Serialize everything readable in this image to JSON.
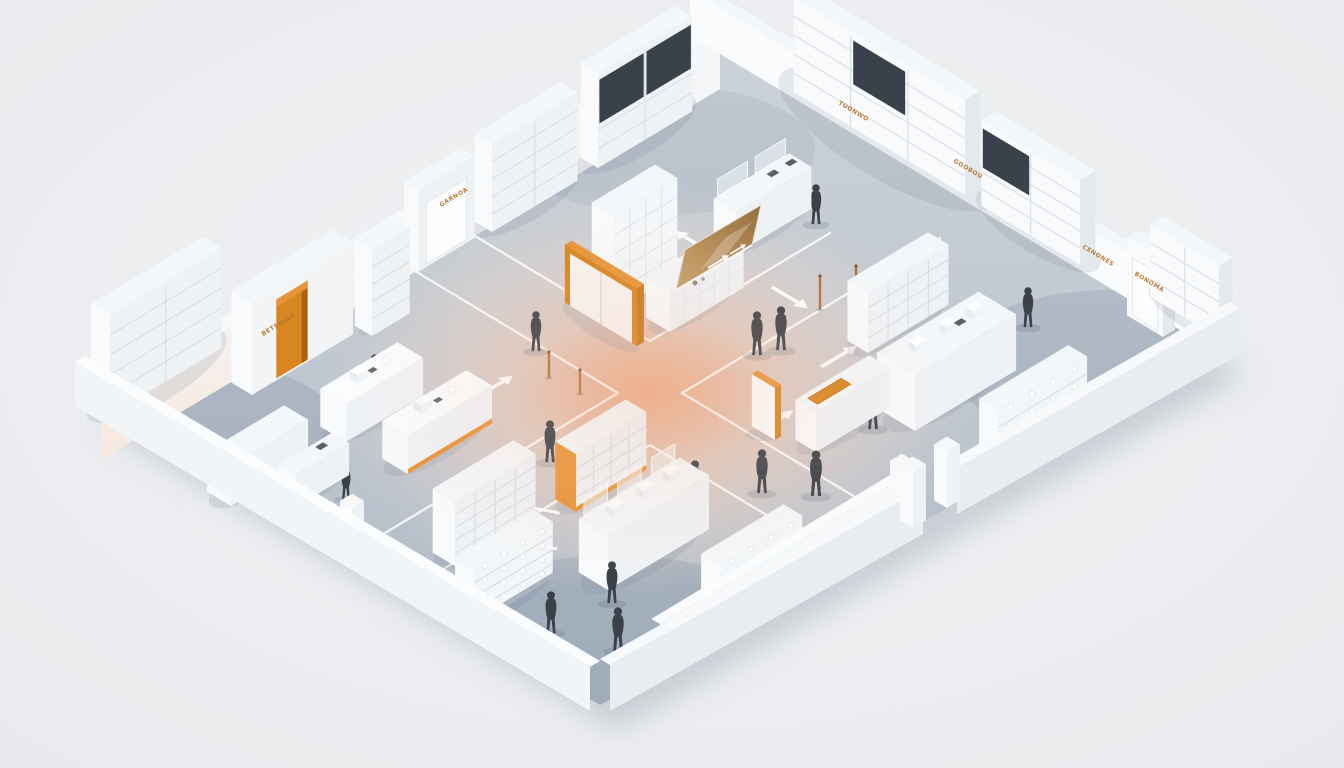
{
  "scene": {
    "description": "Isometric 3D render of a retail store floor plan: four retail zones divided by crossing aisles with white guidance arrows, white shelving and counters, orange accent doors and signage, dark silhouette shoppers, warm glow at the central intersection",
    "style": "isometric-3d-render",
    "people_count": 19
  },
  "palette": {
    "background": "#ecedef",
    "floorLight": "#cdd3d9",
    "floorDark": "#b3bdc7",
    "wall": "#f6f8fa",
    "wallBright": "#fafbfd",
    "wallShade": "#e9edf1",
    "fixtureTop": "#f4f7f9",
    "fixtureFront": "#eff2f5",
    "fixtureBright": "#f9fafc",
    "fixtureSide": "#e4e9ed",
    "shelfLine": "#d8dee3",
    "panelDark": "#39424b",
    "accent": "#d8861f",
    "accentDeep": "#aa630f",
    "accentLight": "#e8953a",
    "accentText": "#b5762a",
    "figure": "#3c4149",
    "lane": "#ffffff",
    "glowCore": "#eea076",
    "glowWarm": "#f0b796"
  },
  "signage": {
    "labels": [
      {
        "id": "w-wardrobe-sign",
        "text": "BETSHINO"
      },
      {
        "id": "w-door-sign",
        "text": "GARNOA"
      },
      {
        "id": "ne-sign-1",
        "text": "TUONWO"
      },
      {
        "id": "ne-sign-2",
        "text": "GOOBOU"
      },
      {
        "id": "ne-sign-3",
        "text": "CENONES"
      },
      {
        "id": "ne-sign-4",
        "text": "BONOMA"
      }
    ]
  },
  "floorplan": {
    "outline": [
      [
        85,
        400
      ],
      [
        700,
        30
      ],
      [
        1230,
        348
      ],
      [
        600,
        705
      ]
    ],
    "center": [
      648,
      392
    ],
    "cornerShades": [
      {
        "cx": 190,
        "cy": 430,
        "rx": 150,
        "ry": 70,
        "o": 0.22
      },
      {
        "cx": 1110,
        "cy": 365,
        "rx": 160,
        "ry": 75,
        "o": 0.2
      },
      {
        "cx": 615,
        "cy": 640,
        "rx": 180,
        "ry": 85,
        "o": 0.26
      },
      {
        "cx": 665,
        "cy": 150,
        "rx": 150,
        "ry": 65,
        "o": 0.12
      }
    ],
    "lanes": [
      [
        [
          470,
          233
        ],
        [
          650,
          341
        ],
        [
          830,
          233
        ]
      ],
      [
        [
          360,
          238
        ],
        [
          618,
          393
        ],
        [
          360,
          548
        ]
      ],
      [
        [
          940,
          238
        ],
        [
          682,
          393
        ],
        [
          940,
          548
        ]
      ],
      [
        [
          392,
          600
        ],
        [
          650,
          445
        ],
        [
          908,
          600
        ]
      ]
    ],
    "arrows": [
      {
        "x": 477,
        "y": 397,
        "dir": "E"
      },
      {
        "x": 710,
        "y": 252,
        "dir": "-S"
      },
      {
        "x": 772,
        "y": 287,
        "dir": "S"
      },
      {
        "x": 777,
        "y": 420,
        "dir": "E",
        "double": true
      },
      {
        "x": 821,
        "y": 367,
        "dir": "E"
      },
      {
        "x": 560,
        "y": 513,
        "deg": 196
      },
      {
        "x": 557,
        "y": 549,
        "deg": 196
      }
    ],
    "walls": {
      "nw": {
        "slabTop": [
          [
            85,
            400
          ],
          [
            700,
            30
          ],
          [
            720,
            34
          ],
          [
            101,
            405
          ]
        ],
        "innerFace": [
          [
            101,
            405
          ],
          [
            720,
            34
          ],
          [
            720,
            89
          ],
          [
            101,
            460
          ]
        ]
      },
      "ne": {
        "face": [
          [
            690,
            36
          ],
          [
            1220,
            354
          ],
          [
            1220,
            308
          ],
          [
            690,
            -10
          ]
        ],
        "top": [
          [
            690,
            -10
          ],
          [
            1220,
            308
          ],
          [
            1230,
            302
          ],
          [
            700,
            -16
          ]
        ]
      },
      "sw": {
        "outerFace": [
          [
            75,
            406
          ],
          [
            590,
            711
          ],
          [
            590,
            667
          ],
          [
            75,
            362
          ]
        ],
        "top": [
          [
            75,
            362
          ],
          [
            590,
            667
          ],
          [
            600,
            661
          ],
          [
            85,
            356
          ]
        ]
      },
      "se": {
        "segs": [
          {
            "outerFace": [
              [
                1240,
                354
              ],
              [
                957,
                514
              ],
              [
                957,
                468
              ],
              [
                1240,
                308
              ]
            ],
            "top": [
              [
                1240,
                308
              ],
              [
                957,
                468
              ],
              [
                947,
                462
              ],
              [
                1230,
                302
              ]
            ]
          },
          {
            "outerFace": [
              [
                923,
                534
              ],
              [
                610,
                711
              ],
              [
                610,
                665
              ],
              [
                923,
                488
              ]
            ],
            "top": [
              [
                923,
                488
              ],
              [
                610,
                665
              ],
              [
                600,
                659
              ],
              [
                913,
                482
              ]
            ]
          }
        ],
        "pillars": [
          [
            947,
            508
          ],
          [
            913,
            528
          ]
        ]
      }
    },
    "objects": [
      {
        "id": "w-wall-shelf-far",
        "kind": "shelf",
        "x": 598,
        "y": 168,
        "len": 110,
        "dep": 20,
        "h": 95,
        "o": "E",
        "bays": 2,
        "lines": 4,
        "panels": [
          0,
          1
        ]
      },
      {
        "id": "ne-wall-shelf-a",
        "kind": "shelf",
        "x": 965,
        "y": 195,
        "len": 200,
        "dep": 18,
        "h": 95,
        "o": "S",
        "bays": 3,
        "lines": 4,
        "panels": [
          1
        ]
      },
      {
        "id": "w-wall-shelf-c",
        "kind": "shelf",
        "x": 492,
        "y": 232,
        "len": 100,
        "dep": 20,
        "h": 88,
        "o": "E",
        "bays": 2,
        "lines": 4
      },
      {
        "id": "person-n-right",
        "kind": "person",
        "x": 816,
        "y": 225,
        "s": 42
      },
      {
        "id": "n-service-desk",
        "kind": "counter",
        "x": 736,
        "y": 254,
        "len": 88,
        "dep": 26,
        "h": 42,
        "o": "E",
        "clear": 2,
        "dark": 2
      },
      {
        "id": "person-n-cabinet",
        "kind": "person",
        "x": 612,
        "y": 257,
        "s": 40
      },
      {
        "id": "ne-wall-shelf-b",
        "kind": "shelf",
        "x": 1080,
        "y": 265,
        "len": 115,
        "dep": 18,
        "h": 85,
        "o": "S",
        "bays": 2,
        "lines": 4,
        "panels": [
          1
        ]
      },
      {
        "id": "w-door-block",
        "kind": "doorblock",
        "x": 418,
        "y": 272,
        "len": 66,
        "dep": 16,
        "h": 82,
        "o": "E"
      },
      {
        "id": "pole-3",
        "kind": "pole",
        "x": 820,
        "y": 310,
        "h": 34
      },
      {
        "id": "pole-4",
        "kind": "pole",
        "x": 856,
        "y": 300,
        "h": 34
      },
      {
        "id": "n-tall-cabinet",
        "kind": "cabinet",
        "x": 614,
        "y": 312,
        "len": 74,
        "dep": 26,
        "h": 96,
        "o": "E",
        "cols": 4,
        "rows": 5
      },
      {
        "id": "n-screen-counter",
        "kind": "counter",
        "x": 670,
        "y": 332,
        "len": 86,
        "dep": 28,
        "h": 40,
        "o": "E",
        "grid": true,
        "dark": 1
      },
      {
        "id": "n-screen",
        "kind": "screen"
      },
      {
        "id": "ne-door-block",
        "kind": "doorblock",
        "x": 1163,
        "y": 337,
        "len": 42,
        "dep": 14,
        "h": 78,
        "o": "S"
      },
      {
        "id": "ne-wall-shelf-c",
        "kind": "shelf",
        "x": 1219,
        "y": 338,
        "len": 80,
        "dep": 16,
        "h": 72,
        "o": "S",
        "bays": 2,
        "lines": 3
      },
      {
        "id": "w-wall-shelf-b",
        "kind": "shelf",
        "x": 372,
        "y": 336,
        "len": 44,
        "dep": 20,
        "h": 86,
        "o": "E",
        "bays": 1,
        "lines": 4
      },
      {
        "id": "person-w-aisle",
        "kind": "person",
        "x": 536,
        "y": 352,
        "s": 42
      },
      {
        "id": "w-wardrobe",
        "kind": "wardrobe",
        "x": 252,
        "y": 395,
        "len": 118,
        "dep": 24,
        "h": 92
      },
      {
        "id": "w-center-door",
        "kind": "doubledoor",
        "x": 637,
        "y": 346,
        "len": 84,
        "h": 58
      },
      {
        "id": "person-pair-a",
        "kind": "person",
        "x": 757,
        "y": 356,
        "s": 46
      },
      {
        "id": "person-pair-b",
        "kind": "person",
        "x": 781,
        "y": 351,
        "s": 46,
        "flip": true
      },
      {
        "id": "pole-1",
        "kind": "pole",
        "x": 549,
        "y": 378,
        "h": 26
      },
      {
        "id": "pole-2",
        "kind": "pole",
        "x": 580,
        "y": 394,
        "h": 24
      },
      {
        "id": "person-e-walker",
        "kind": "person",
        "x": 1028,
        "y": 328,
        "s": 42,
        "flip": true
      },
      {
        "id": "person-e-upper",
        "kind": "person",
        "x": 984,
        "y": 347,
        "s": 40
      },
      {
        "id": "e-gondola",
        "kind": "shelf",
        "x": 868,
        "y": 353,
        "len": 94,
        "dep": 24,
        "h": 60,
        "o": "E",
        "bays": 4,
        "lines": 3
      },
      {
        "id": "person-e-island",
        "kind": "person",
        "x": 921,
        "y": 374,
        "s": 44
      },
      {
        "id": "person-w-table",
        "kind": "person",
        "x": 375,
        "y": 397,
        "s": 44
      },
      {
        "id": "w-shelf-left",
        "kind": "shelf",
        "x": 110,
        "y": 415,
        "len": 130,
        "dep": 22,
        "h": 100,
        "o": "E",
        "bays": 2,
        "lines": 4
      },
      {
        "id": "w-table-1",
        "kind": "table",
        "x": 346,
        "y": 442,
        "len": 90,
        "dep": 30,
        "h": 38
      },
      {
        "id": "e-island",
        "kind": "counter",
        "x": 915,
        "y": 431,
        "len": 118,
        "dep": 44,
        "h": 56,
        "o": "E",
        "white": 3,
        "dark": 1
      },
      {
        "id": "person-e-orange",
        "kind": "person",
        "x": 873,
        "y": 430,
        "s": 46
      },
      {
        "id": "e-door",
        "kind": "door",
        "x": 775,
        "y": 440,
        "len": 27,
        "h": 52
      },
      {
        "id": "e-orange-counter",
        "kind": "counter",
        "x": 816,
        "y": 452,
        "len": 86,
        "dep": 24,
        "h": 40,
        "o": "E",
        "inlay": true
      },
      {
        "id": "person-w-aisle-2",
        "kind": "person",
        "x": 550,
        "y": 463,
        "s": 44
      },
      {
        "id": "w-table-2",
        "kind": "table",
        "x": 408,
        "y": 474,
        "len": 98,
        "dep": 30,
        "h": 38,
        "accentBase": true
      },
      {
        "id": "e-glass-shelf",
        "kind": "glassshelf",
        "x": 998,
        "y": 462,
        "len": 104,
        "dep": 22,
        "h": 52,
        "o": "E",
        "lines": 2
      },
      {
        "id": "person-w-reception",
        "kind": "person",
        "x": 300,
        "y": 480,
        "s": 34
      },
      {
        "id": "w-reception",
        "kind": "counter",
        "x": 231,
        "y": 506,
        "len": 90,
        "dep": 28,
        "h": 40,
        "o": "E"
      },
      {
        "id": "person-w-checkout",
        "kind": "person",
        "x": 346,
        "y": 500,
        "s": 36,
        "flip": true
      },
      {
        "id": "w-checkout",
        "kind": "counter",
        "x": 296,
        "y": 507,
        "len": 62,
        "dep": 20,
        "h": 32,
        "o": "E",
        "dark": 1
      },
      {
        "id": "person-s-walker",
        "kind": "person",
        "x": 695,
        "y": 503,
        "s": 44,
        "flip": true
      },
      {
        "id": "person-se-a",
        "kind": "person",
        "x": 762,
        "y": 494,
        "s": 46
      },
      {
        "id": "person-se-b",
        "kind": "person",
        "x": 816,
        "y": 497,
        "s": 48
      },
      {
        "id": "w-s-wall",
        "kind": "lowwall",
        "x1": 188,
        "y1": 465,
        "x2": 352,
        "y2": 556,
        "h": 38,
        "dir": "S",
        "pillar": [
          352,
          556
        ]
      },
      {
        "id": "s-gondola",
        "kind": "shelf",
        "x": 576,
        "y": 512,
        "len": 82,
        "dep": 24,
        "h": 58,
        "o": "E",
        "bays": 4,
        "lines": 3,
        "accentSides": true
      },
      {
        "id": "s-shelf-blue",
        "kind": "shelf",
        "x": 455,
        "y": 566,
        "len": 94,
        "dep": 26,
        "h": 64,
        "o": "E",
        "bays": 4,
        "lines": 4,
        "baseDark": true
      },
      {
        "id": "s-display-counter",
        "kind": "counter",
        "x": 608,
        "y": 590,
        "len": 118,
        "dep": 34,
        "h": 54,
        "o": "E",
        "clear": 3,
        "white": 3
      },
      {
        "id": "person-s-counter",
        "kind": "person",
        "x": 612,
        "y": 604,
        "s": 44
      },
      {
        "id": "s-glass-2",
        "kind": "glassshelf",
        "x": 720,
        "y": 617,
        "len": 96,
        "dep": 22,
        "h": 52,
        "o": "E",
        "lines": 3
      },
      {
        "id": "s-ne-wall",
        "kind": "lowwall",
        "x1": 660,
        "y1": 660,
        "x2": 902,
        "y2": 514,
        "h": 36,
        "dir": "E",
        "pillar": [
          902,
          514
        ]
      },
      {
        "id": "s-glass-1",
        "kind": "glassshelf",
        "x": 474,
        "y": 625,
        "len": 92,
        "dep": 22,
        "h": 56,
        "o": "E",
        "lines": 3
      },
      {
        "id": "person-s-lower",
        "kind": "person",
        "x": 551,
        "y": 634,
        "s": 44,
        "flip": true
      },
      {
        "id": "person-s-bottom",
        "kind": "person",
        "x": 618,
        "y": 652,
        "s": 46
      }
    ]
  }
}
